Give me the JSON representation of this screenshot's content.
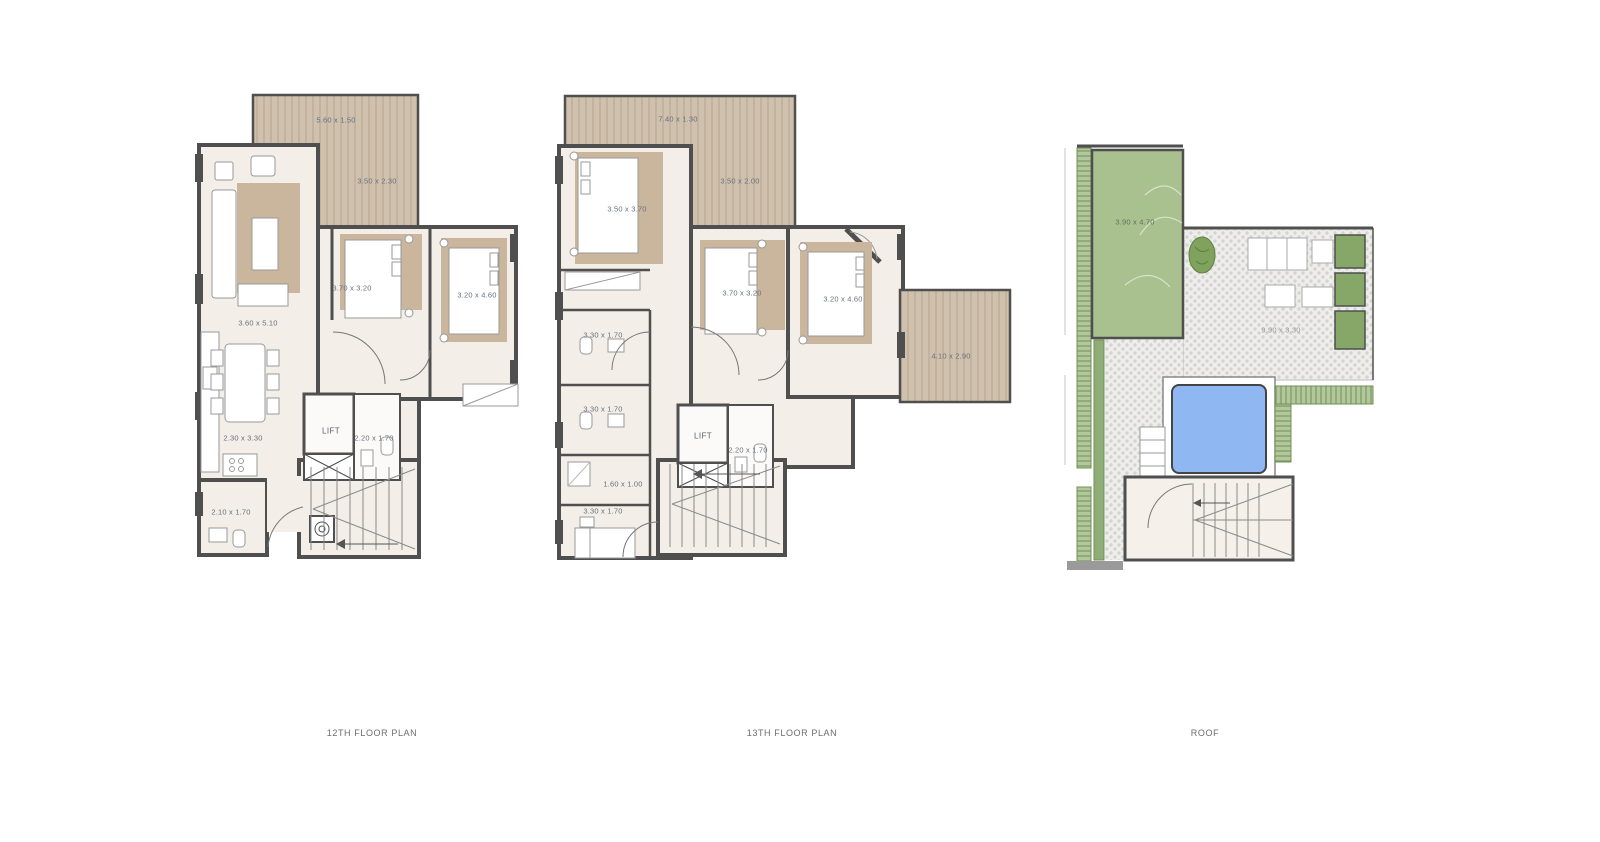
{
  "colors": {
    "wall": "#4f4f4f",
    "floor": "#f3eee7",
    "deck_wood": "#cfc1ae",
    "rug_tan": "#c9b69c",
    "lawn_green": "#a9c08f",
    "planter_green": "#86a768",
    "hatch_green": "#b3c79c",
    "pool_blue": "#8fb7f2",
    "paving_dot": "#d4d4d0",
    "label_text": "#69707e",
    "caption_text": "#6d6d6d"
  },
  "plans": [
    {
      "caption": "12TH FLOOR PLAN",
      "labels": {
        "terrace_top": "5.60 x 1.50",
        "terrace_side": "3.50 x 2.30",
        "living": "3.60 x 5.10",
        "bedroom1": "3.70 x 3.20",
        "bedroom2": "3.20 x 4.60",
        "dining": "2.30 x 3.30",
        "lift": "LIFT",
        "bath": "2.20 x 1.70",
        "bath2": "2.10 x 1.70"
      }
    },
    {
      "caption": "13TH FLOOR PLAN",
      "labels": {
        "terrace_top": "7.40 x 1.30",
        "terrace_side": "3.50 x 2.00",
        "bedroom1": "3.50 x 3.70",
        "bedroom2": "3.70 x 3.20",
        "bedroom3": "3.20 x 4.60",
        "terrace_right": "4.10 x 2.90",
        "bath1": "3.30 x 1.70",
        "bath2": "3.30 x 1.70",
        "hall": "1.60 x 1.00",
        "bath3": "3.30 x 1.70",
        "lift": "LIFT",
        "bath4": "2.20 x 1.70"
      }
    },
    {
      "caption": "ROOF",
      "labels": {
        "garden": "3.90 x 4.70",
        "terrace": "9.90 x 3.30"
      }
    }
  ]
}
